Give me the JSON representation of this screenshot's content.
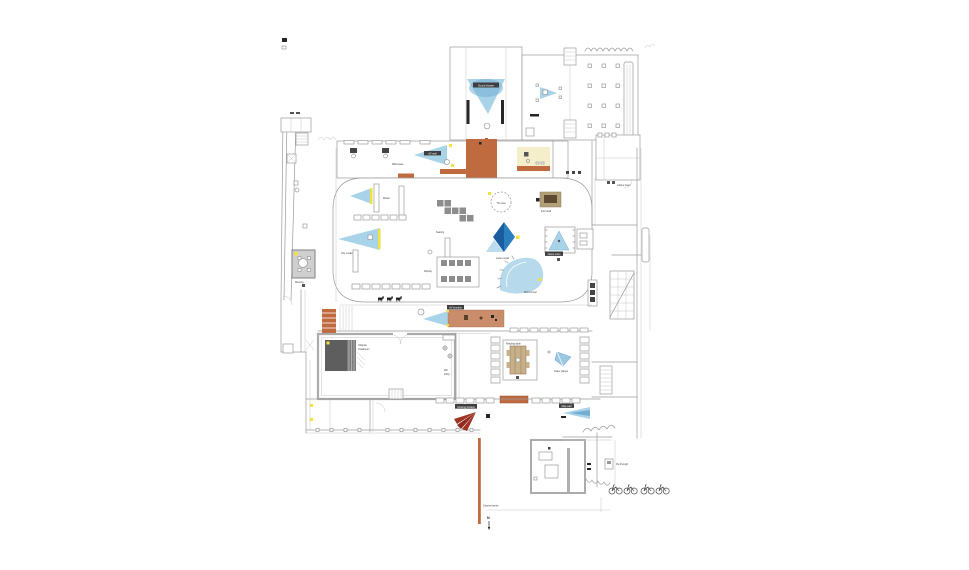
{
  "plan": {
    "type": "architectural-floor-plan",
    "colors": {
      "wall": "#9a9a9a",
      "terracotta": "#bf6a3f",
      "salmon": "#c98d6b",
      "pale_yellow": "#f5eecb",
      "yellow": "#f2e23c",
      "light_blue": "#a9d3e8",
      "mid_blue": "#74aed3",
      "deep_blue": "#1a5c9e",
      "gray_block": "#8d8d8d",
      "dark_gray": "#5e5e5e",
      "tan": "#b2a078",
      "brown": "#5c4a33",
      "red": "#a03524"
    },
    "labels": {
      "sound_booth": "Sound shower",
      "gallery_cone": "AV wall",
      "gallery_cases": "Wall cases",
      "model_shelf": "Model",
      "city_model": "City model",
      "seating": "Seating",
      "framed_exhibit": "Display",
      "lens": "The lens",
      "diamond_exhibit": "Laser model",
      "kiosk": "Info kiosk",
      "glass_room": "Glass room",
      "wind_tunnel": "Wind tunnel",
      "lattice_tower": "Lattice tower",
      "av_timeline": "AV timeline",
      "chapple_1": "Chapple",
      "chapple_2": "Cloakroom",
      "reading_table": "Reading table",
      "paper_planes": "Paper planes",
      "wc_1": "WC",
      "wc_2": "lobby",
      "meeting_room": "Meeting",
      "viewing_window": "Viewing window",
      "map_wall": "Map wall",
      "fly_through": "Fly-through",
      "barrier_line": "Charter barrier",
      "north": "N"
    }
  }
}
